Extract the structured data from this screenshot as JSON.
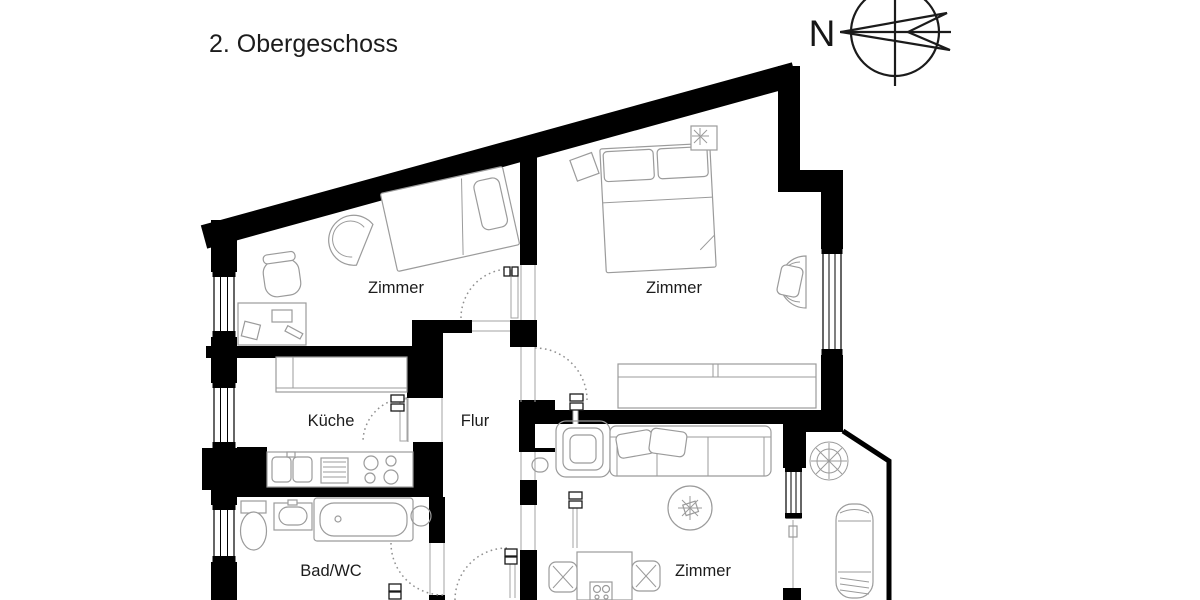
{
  "title": "2. Obergeschoss",
  "compass": {
    "north_label": "N"
  },
  "rooms": {
    "zimmer_top_left": "Zimmer",
    "zimmer_top_right": "Zimmer",
    "zimmer_bottom": "Zimmer",
    "kueche": "Küche",
    "flur": "Flur",
    "bad_wc": "Bad/WC"
  },
  "colors": {
    "wall": "#000000",
    "furn": "#9b9b9b",
    "door": "#8f8f8f",
    "text": "#1c1c1c",
    "bg": "#ffffff"
  }
}
